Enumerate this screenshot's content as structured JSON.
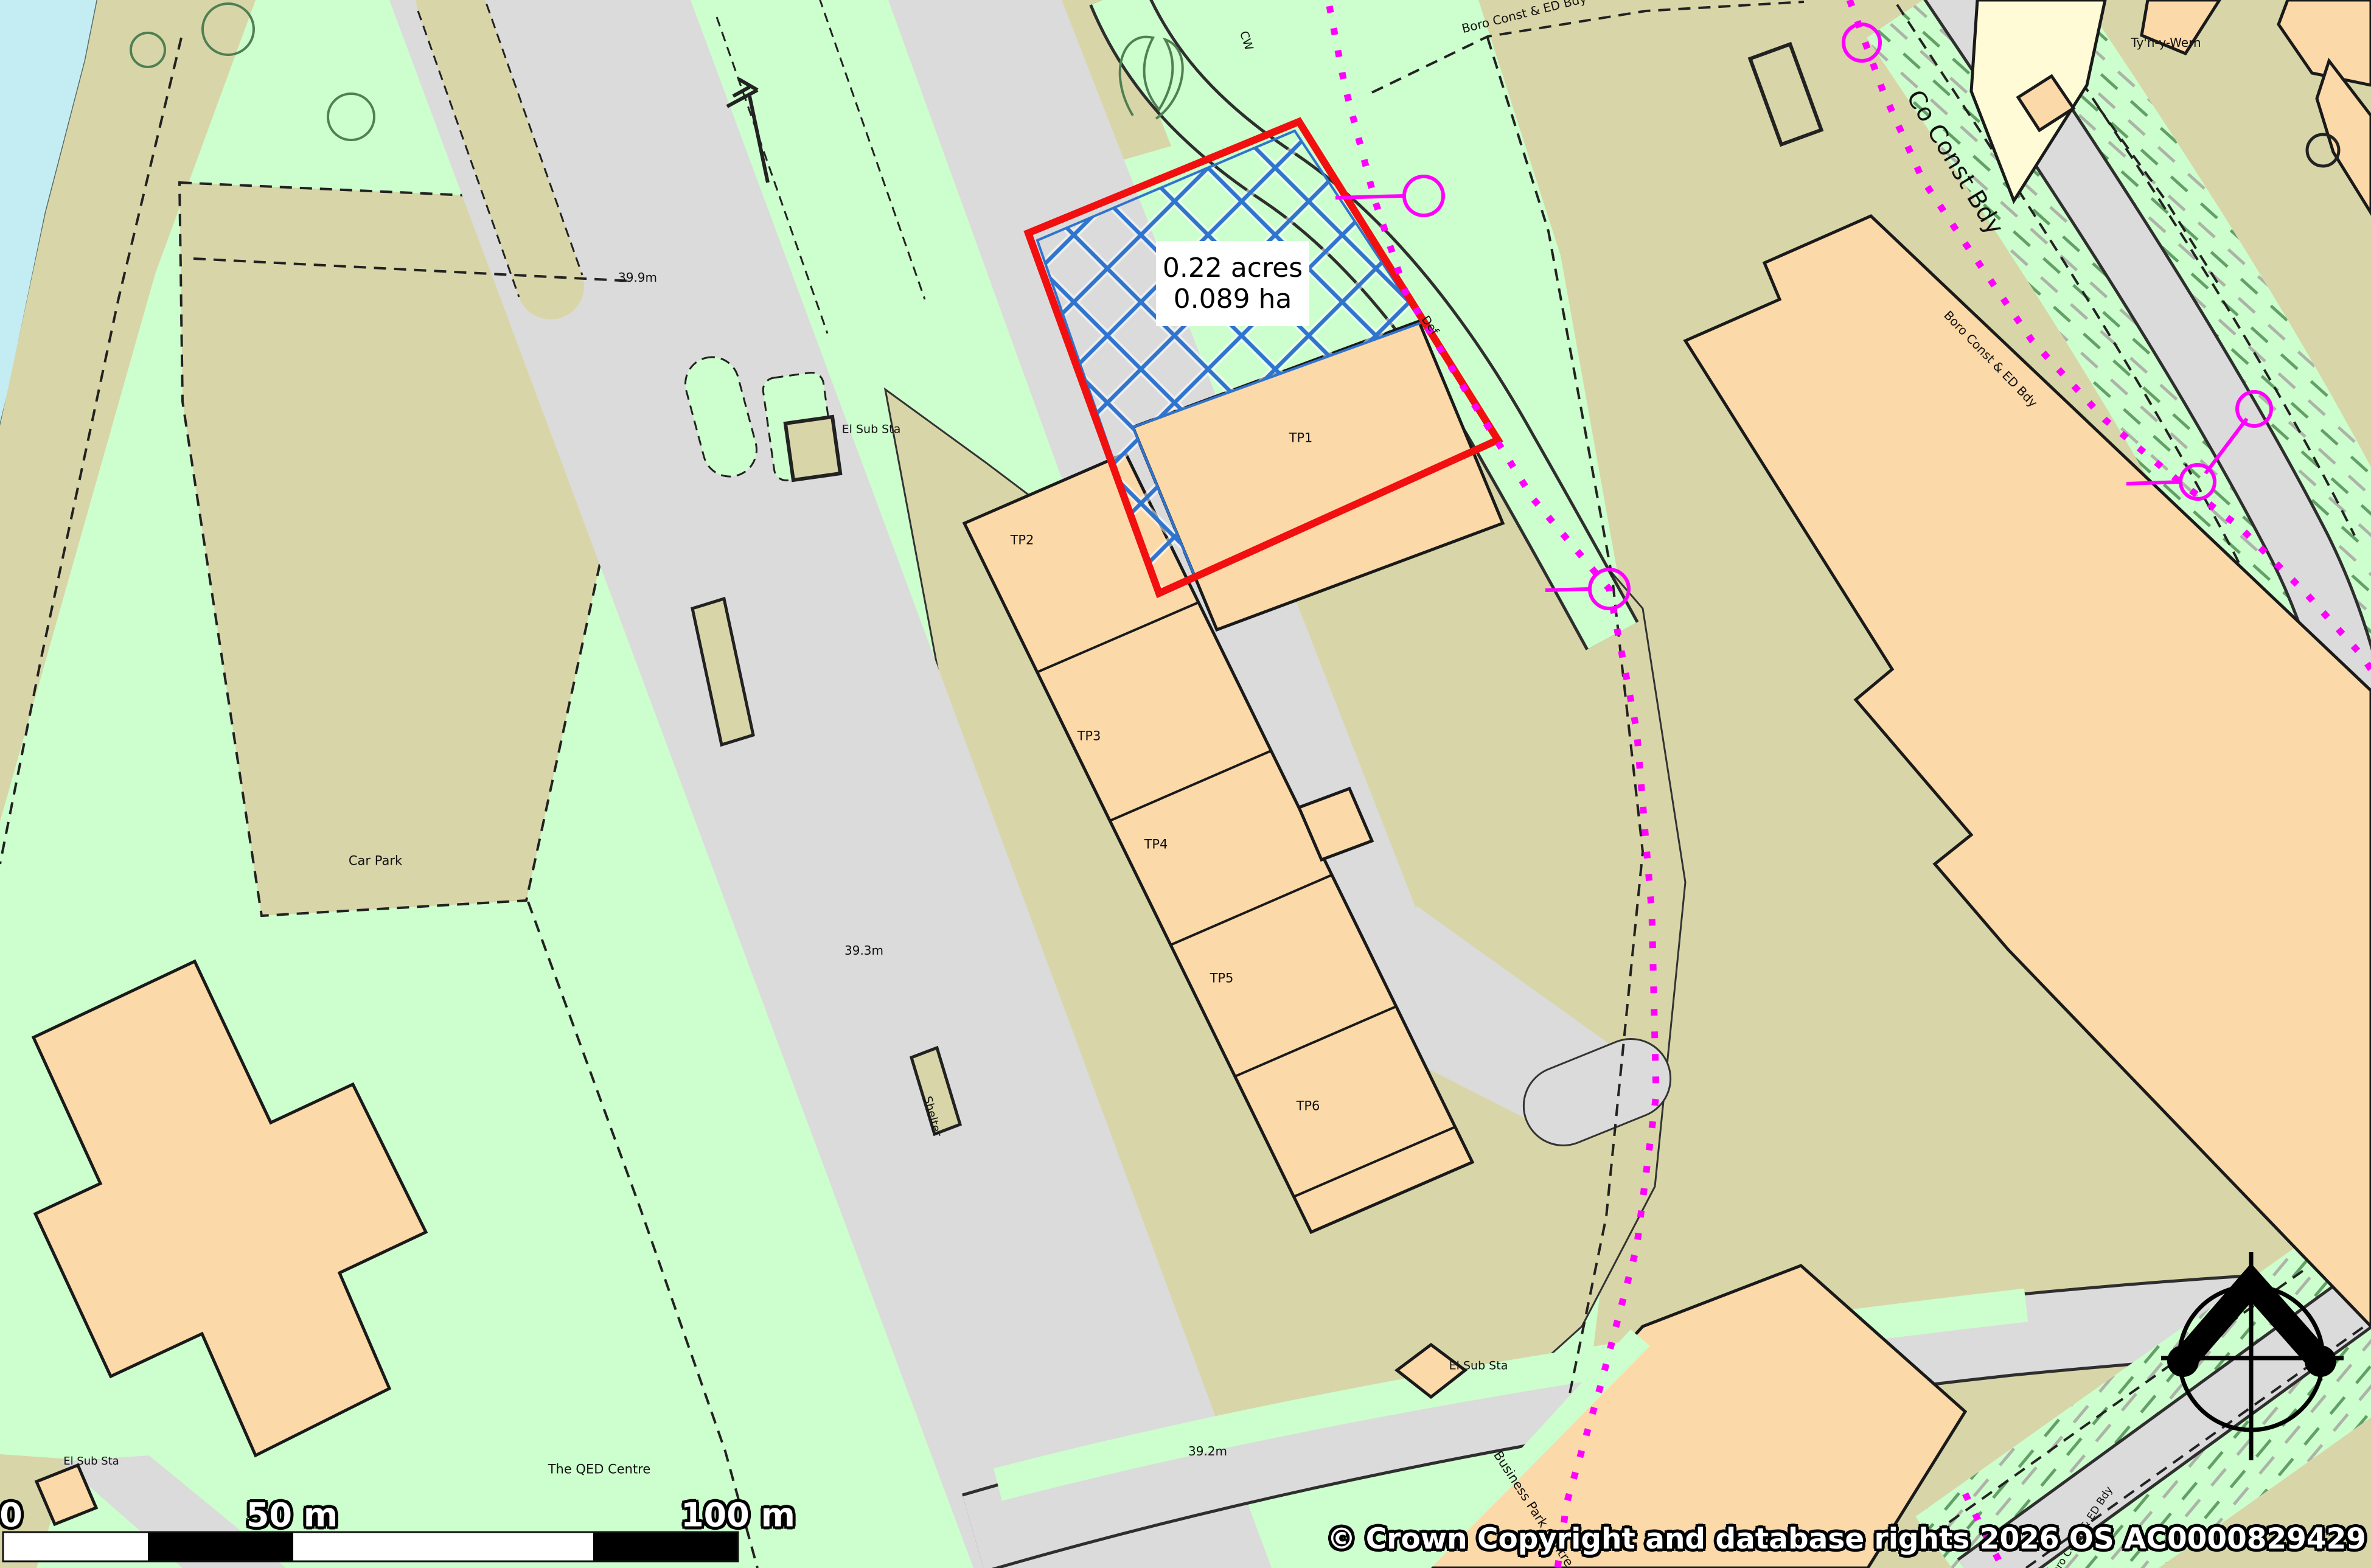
{
  "map": {
    "area_label": {
      "acres": "0.22 acres",
      "hectares": "0.089 ha"
    },
    "plots": {
      "tp1": "TP1",
      "tp2": "TP2",
      "tp3": "TP3",
      "tp4": "TP4",
      "tp5": "TP5",
      "tp6": "TP6"
    },
    "labels": {
      "elev_399": "39.9m",
      "elev_393": "39.3m",
      "elev_392": "39.2m",
      "el_sub_sta": "El Sub Sta",
      "car_park": "Car Park",
      "shelter": "Shelter",
      "qed_centre": "The QED Centre",
      "business_park_centre": "Business Park Centre",
      "tyn_y_wern": "Ty'n-y-Wern",
      "cw": "CW",
      "def": "Def"
    },
    "boundaries": {
      "co_const_bdy": "Co Const Bdy",
      "boro_const_ed_bdy": "Boro Const & ED Bdy"
    },
    "scale_bar": {
      "zero": "0",
      "fifty": "50 m",
      "hundred": "100 m"
    },
    "copyright": "© Crown Copyright and database rights 2026 OS AC0000829429",
    "colors": {
      "plot_outline_red": "#F10F0F",
      "hatch_blue": "#2F74CE",
      "boundary_magenta": "#FF00FF",
      "water": "#C3EDF2",
      "grass": "#CDFECD",
      "ground": "#D8D6A8",
      "road": "#DBDBDB",
      "building": "#FCD9A8",
      "building_pale": "#FEFBD6"
    }
  }
}
